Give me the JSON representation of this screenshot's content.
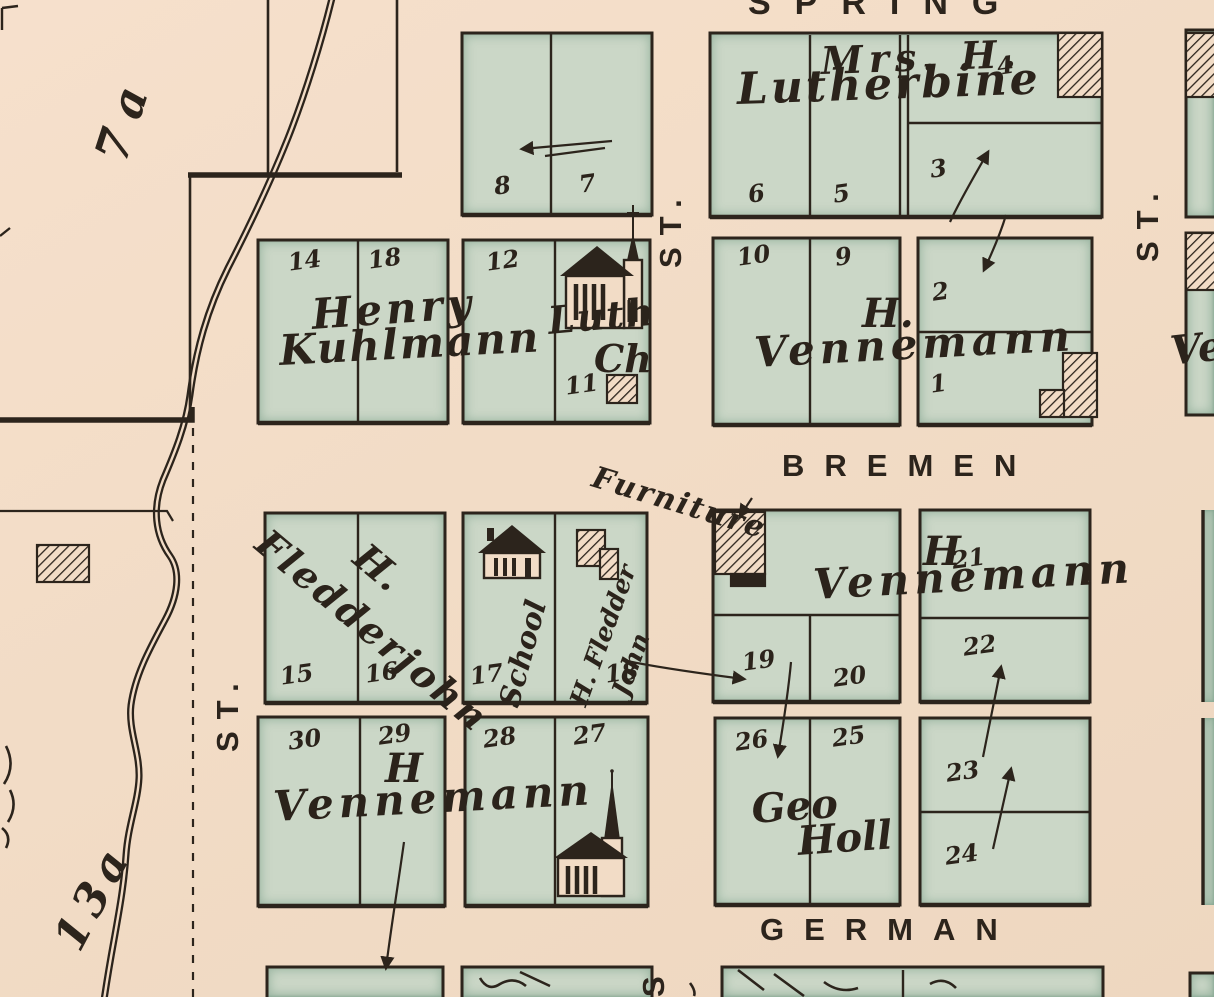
{
  "streets": {
    "spring": "SPRING",
    "bremen": "BREMEN",
    "german": "GERMAN",
    "st": "ST.",
    "s": "S"
  },
  "annotations": {
    "furniture": "Furniture",
    "parcel_7a": "7a",
    "parcel_13a": "13a"
  },
  "owners": {
    "lutherbine": {
      "line1": "Mrs. H.",
      "line2": "Lutherbine"
    },
    "kuhlmann": {
      "line1": "Henry",
      "line2": "Kuhlmann"
    },
    "luth_ch": {
      "line1": "Luth",
      "line2": "Ch"
    },
    "vennemann_ne": {
      "initial": "H.",
      "name": "Vennemann"
    },
    "vennemann_mid": {
      "initial": "H",
      "name": "Vennemann"
    },
    "vennemann_sw": {
      "initial": "H",
      "name": "Vennemann"
    },
    "fledderjohn": {
      "initial": "H.",
      "name": "Fledderjohn"
    },
    "fledderjohn_lot18": {
      "line1": "H. Fledder",
      "line2": "John"
    },
    "school": "School",
    "geo_holl": {
      "line1": "Geo",
      "line2": "Holl"
    },
    "vennemann_partial": "Ve"
  },
  "lots": {
    "n8": "8",
    "n7": "7",
    "n4": "4",
    "n6": "6",
    "n5": "5",
    "n3": "3",
    "n14": "14",
    "n18a": "18",
    "n12": "12",
    "n11": "11",
    "n10": "10",
    "n9": "9",
    "n2": "2",
    "n1": "1",
    "n15": "15",
    "n16": "16",
    "n17": "17",
    "n18b": "18",
    "n19": "19",
    "n20": "20",
    "n21": "21",
    "n22": "22",
    "n30": "30",
    "n29": "29",
    "n28": "28",
    "n27": "27",
    "n26": "26",
    "n25": "25",
    "n23": "23",
    "n24": "24"
  },
  "colors": {
    "paper": "#f2dcc6",
    "block_green": "#cbd7c7",
    "ink": "#2c241c"
  }
}
